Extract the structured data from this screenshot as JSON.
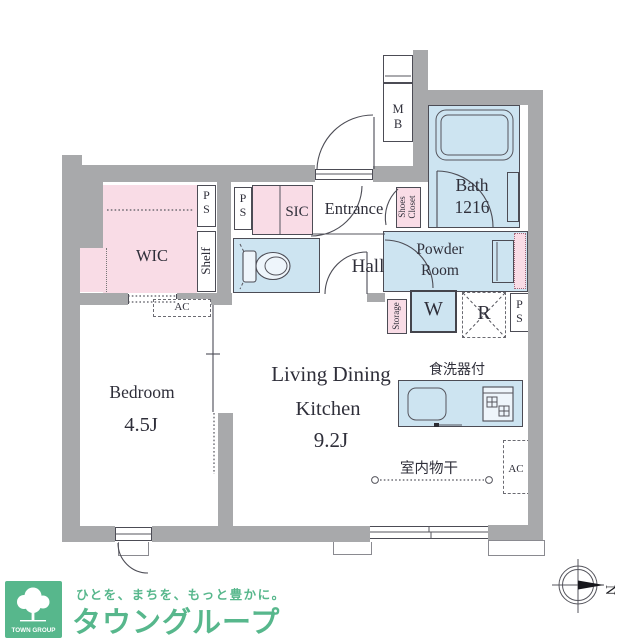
{
  "floorplan": {
    "rooms": {
      "wic": {
        "label": "WIC"
      },
      "bedroom": {
        "label": "Bedroom",
        "size": "4.5J"
      },
      "ldk": {
        "line1": "Living Dining",
        "line2": "Kitchen",
        "size": "9.2J"
      },
      "entrance": {
        "label": "Entrance"
      },
      "hall": {
        "label": "Hall"
      },
      "bath": {
        "label": "Bath\n1216"
      },
      "powder_room": {
        "label": "Powder\nRoom"
      }
    },
    "closets": {
      "sic": "SIC",
      "shoes_closet": "Shoes\nCloset",
      "shelf": "Shelf",
      "storage": "Storage"
    },
    "equipment": {
      "pipe_space": "P\nS",
      "meter_box": "M\nB",
      "washer": "W",
      "refrigerator": "R",
      "air_conditioner": "AC",
      "dishwasher_note": "食洗器付",
      "indoor_drying_note": "室内物干"
    },
    "compass_north": "N"
  },
  "branding": {
    "badge_text": "TOWN GROUP",
    "tagline": "ひとを、まちを、もっと豊かに。",
    "brand_name": "タウングループ"
  },
  "colors": {
    "wall": "#a8a9ab",
    "pink": "#f9dce6",
    "blue": "#cde4f1",
    "line": "#4c4c55",
    "text": "#2f2f3a",
    "green": "#57b78c",
    "fixture": "#eef5fb"
  }
}
